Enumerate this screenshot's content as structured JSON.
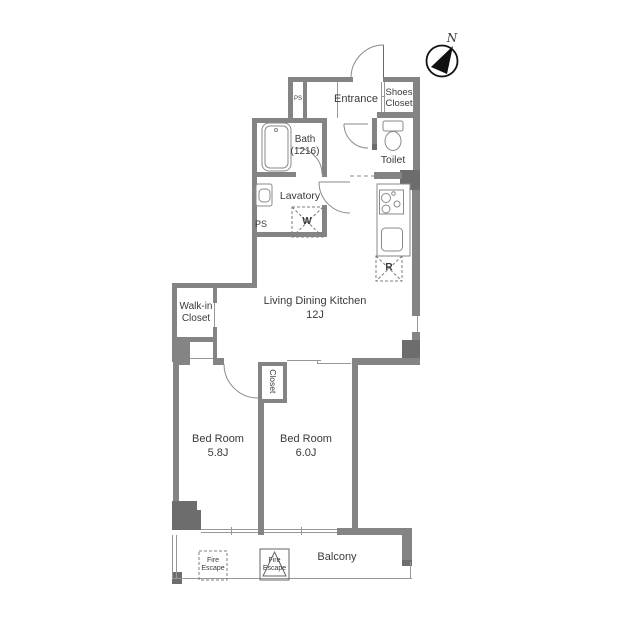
{
  "compass": {
    "north": "N"
  },
  "rooms": {
    "entrance": "Entrance",
    "shoes_closet": "Shoes\nCloset",
    "pipe_shaft_top": "PS",
    "bath": "Bath\n(1216)",
    "toilet": "Toilet",
    "lavatory": "Lavatory",
    "pipe_shaft": "PS",
    "ldk": "Living Dining Kitchen\n12J",
    "walk_in_closet": "Walk-in\nCloset",
    "closet": "Closet",
    "bedroom_1": "Bed Room\n5.8J",
    "bedroom_2": "Bed Room\n6.0J",
    "balcony": "Balcony"
  },
  "fixtures": {
    "washer": "W",
    "refrigerator": "R",
    "fire_escape_1": "Fire\nEscape",
    "fire_escape_2": "Fire\nEscape"
  },
  "colors": {
    "wall": "#848484",
    "wall_dark": "#6d6d6d",
    "line": "#8a8a8a",
    "text": "#3a3a3a"
  }
}
